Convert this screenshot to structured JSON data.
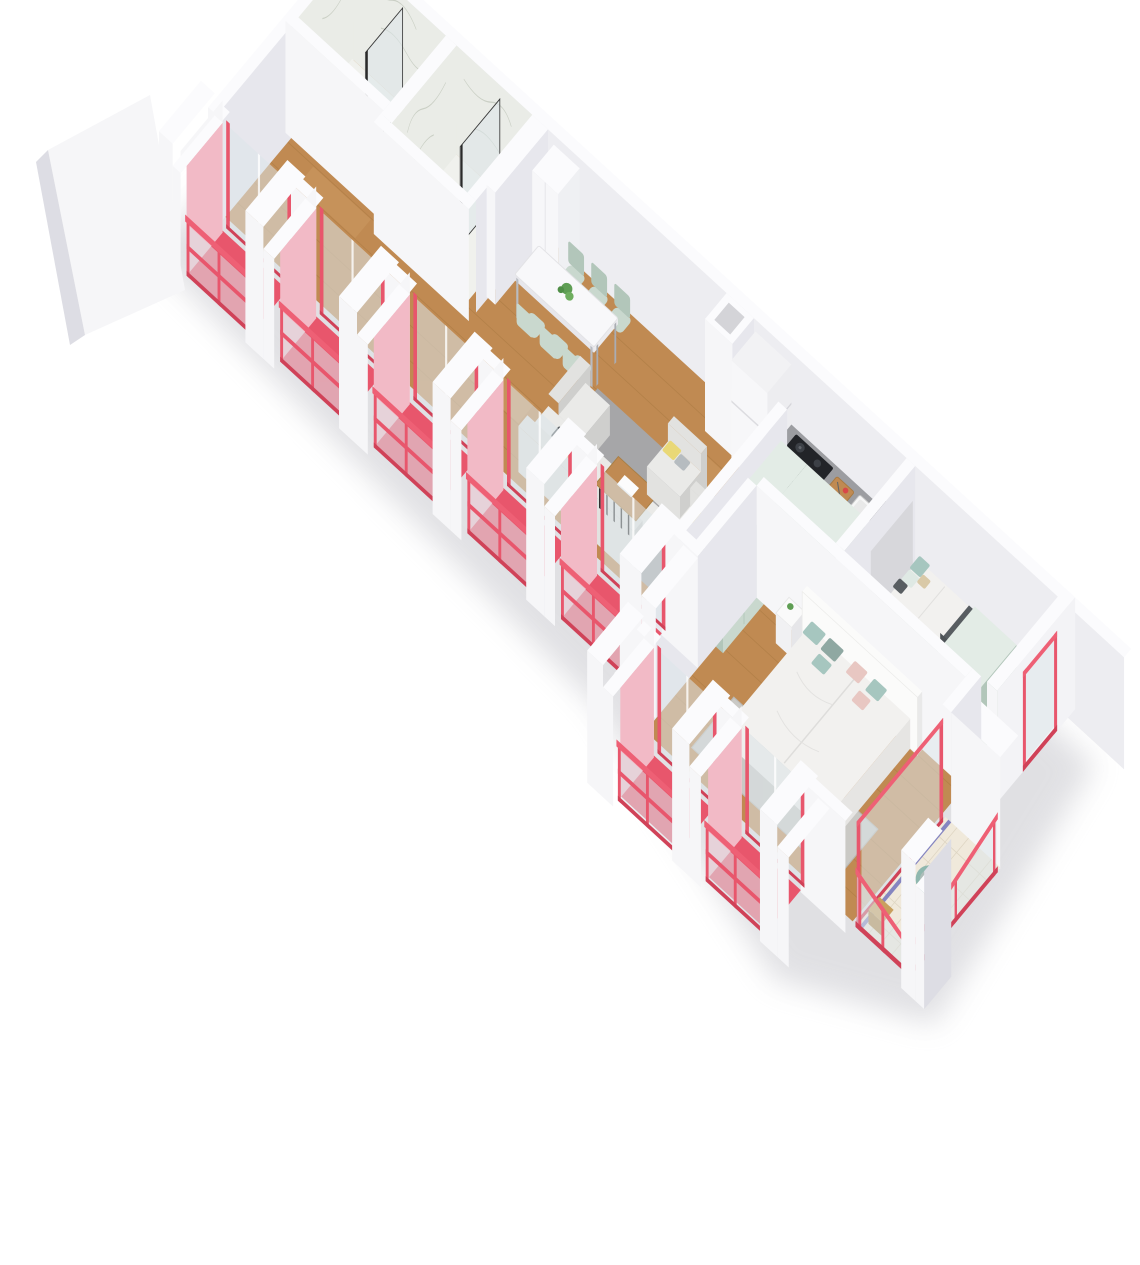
{
  "meta": {
    "type": "3d-floor-plan-render",
    "view": "isometric-cutaway",
    "background": "#ffffff",
    "text_on_image": "none"
  },
  "palette": {
    "wall_white": "#f6f6f8",
    "wall_top": "#fbfbfd",
    "wall_shade": "#e7e7ed",
    "wall_dark": "#dddde4",
    "wall_inner": "#ededf1",
    "wood": "#c08a52",
    "wood_dark": "#a4763e",
    "wood_light": "#dcae77",
    "marble": "#eaece7",
    "marble_floor": "#f0f1ed",
    "marble_vein": "#c7ccc1",
    "glass": "#dde6ea",
    "red": "#e8566c",
    "red_dark": "#d04258",
    "red_rail": "#ee6075",
    "pink": "#f2bac6",
    "mint": "#c9d8ce",
    "mint_dark": "#b2c6ba",
    "mint_top": "#e3ece6",
    "counter": "#9c9da1",
    "appliance_black": "#222428",
    "rug": "#a6a6a8",
    "rug_beige": "#cac9c5",
    "sofa": "#e2e2e0",
    "sofa_dark": "#cfcfcd",
    "sofa_seat": "#eaeae8",
    "bed_white": "#f2f1ef",
    "headboard": "#fbfbfa",
    "pillow_yellow": "#e9d877",
    "pillow_gray": "#b6bcc0",
    "pillow_dark": "#585d61",
    "pillow_teal": "#a6c6bf",
    "pillow_pink": "#e8c7c2",
    "pillow_beige": "#d9c9a7",
    "tile": "#f0e9db",
    "tile_blue": "#7273bb",
    "teal_chair": "#8fb7ae",
    "plant": "#5f9e54",
    "shadow": "#b9b9c0"
  },
  "scene": {
    "rooms": [
      {
        "name": "bathroom-1",
        "finish": "marble",
        "fixtures": [
          "shower-screen",
          "toilet",
          "bidet"
        ]
      },
      {
        "name": "bathroom-2",
        "finish": "marble",
        "fixtures": [
          "shower-screen"
        ]
      },
      {
        "name": "hallway",
        "finish": "wood"
      },
      {
        "name": "dining-area",
        "furniture": [
          "dining-table",
          "six-chairs",
          "plant"
        ]
      },
      {
        "name": "kitchen",
        "furniture": [
          "fridge",
          "cabinet-run",
          "cooktop",
          "oven",
          "cutting-board",
          "sink",
          "coffee-machine"
        ]
      },
      {
        "name": "living-room",
        "furniture": [
          "corner-sofa",
          "armchair",
          "armchair",
          "coffee-table",
          "rug"
        ]
      },
      {
        "name": "wardrobe-hall",
        "furniture": [
          "l-shaped-wardrobe"
        ]
      },
      {
        "name": "bedroom",
        "furniture": [
          "single-bed",
          "wardrobe"
        ]
      },
      {
        "name": "master-bedroom",
        "furniture": [
          "double-bed",
          "headboard",
          "nightstand",
          "nightstand",
          "rug"
        ]
      },
      {
        "name": "balconies",
        "count": 8,
        "features": [
          "red-floor",
          "red-railing",
          "glass-panels",
          "white-pillars",
          "tiled-terrace",
          "tub-chair"
        ]
      }
    ]
  }
}
